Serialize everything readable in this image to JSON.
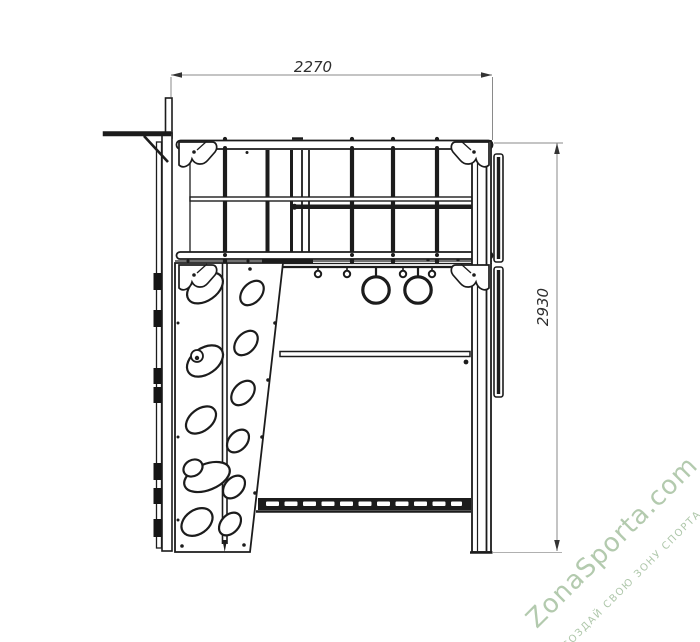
{
  "drawing": {
    "type": "technical-elevation",
    "subject": "playground sports structure side view",
    "top_dimension": "2270",
    "side_dimension": "2930",
    "components": [
      "ladder-post",
      "top-bridge-railing",
      "corner-brackets",
      "gymnastic-rings",
      "hanger-hooks",
      "climbing-wall-with-holes",
      "monkey-bar-rung-beam",
      "support-post"
    ]
  },
  "watermark": {
    "brand": "ZonaSporta.com",
    "tagline": "СОЗДАЙ СВОЮ ЗОНУ СПОРТА"
  },
  "colors": {
    "line": "#1c1c1c",
    "dimension_line": "#8a8a8a",
    "dimension_text": "#2e2e2e",
    "watermark": "#a6c1a1",
    "background": "#ffffff"
  }
}
